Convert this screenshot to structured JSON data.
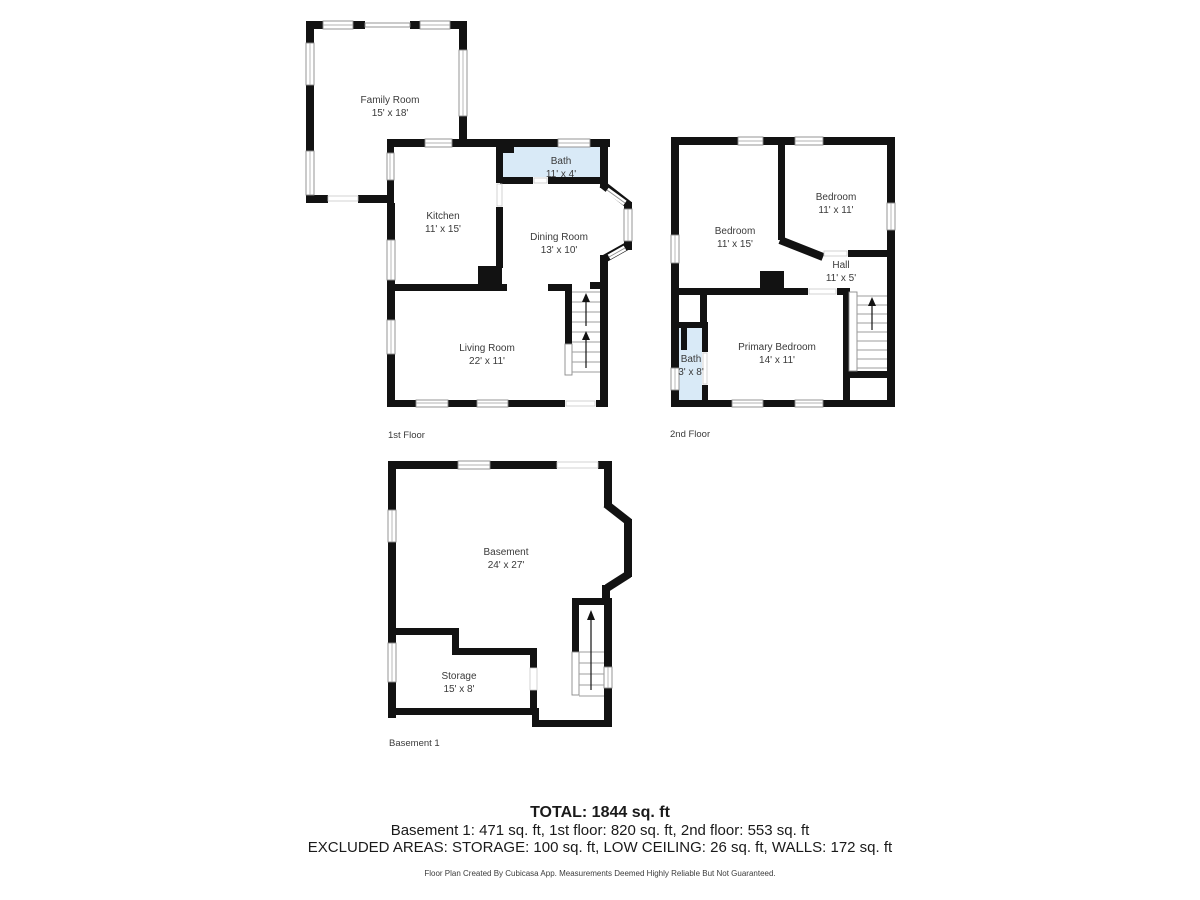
{
  "colors": {
    "wall": "#121212",
    "bath_fill": "#d9eaf7",
    "label_text": "#3a3a3a",
    "window_border": "#8a8a8a"
  },
  "floors": {
    "first": {
      "label": "1st Floor",
      "rooms": {
        "family_room": {
          "name": "Family Room",
          "dims": "15' x 18'"
        },
        "kitchen": {
          "name": "Kitchen",
          "dims": "11' x 15'"
        },
        "bath": {
          "name": "Bath",
          "dims": "11' x 4'"
        },
        "dining_room": {
          "name": "Dining Room",
          "dims": "13' x 10'"
        },
        "living_room": {
          "name": "Living Room",
          "dims": "22' x 11'"
        }
      }
    },
    "second": {
      "label": "2nd Floor",
      "rooms": {
        "bedroom_left": {
          "name": "Bedroom",
          "dims": "11' x 15'"
        },
        "bedroom_right": {
          "name": "Bedroom",
          "dims": "11' x 11'"
        },
        "hall": {
          "name": "Hall",
          "dims": "11' x 5'"
        },
        "primary_bedroom": {
          "name": "Primary Bedroom",
          "dims": "14' x 11'"
        },
        "bath": {
          "name": "Bath",
          "dims": "3' x 8'"
        }
      }
    },
    "basement": {
      "label": "Basement 1",
      "rooms": {
        "basement": {
          "name": "Basement",
          "dims": "24' x 27'"
        },
        "storage": {
          "name": "Storage",
          "dims": "15' x 8'"
        }
      }
    }
  },
  "summary": {
    "total": "TOTAL: 1844 sq. ft",
    "floors_line": "Basement 1: 471 sq. ft, 1st floor: 820 sq. ft, 2nd floor: 553 sq. ft",
    "excluded_line": "EXCLUDED AREAS: STORAGE: 100 sq. ft, LOW CEILING: 26 sq. ft, WALLS: 172 sq. ft"
  },
  "footer": {
    "note": "Floor Plan Created By Cubicasa App. Measurements Deemed Highly Reliable But Not Guaranteed."
  }
}
